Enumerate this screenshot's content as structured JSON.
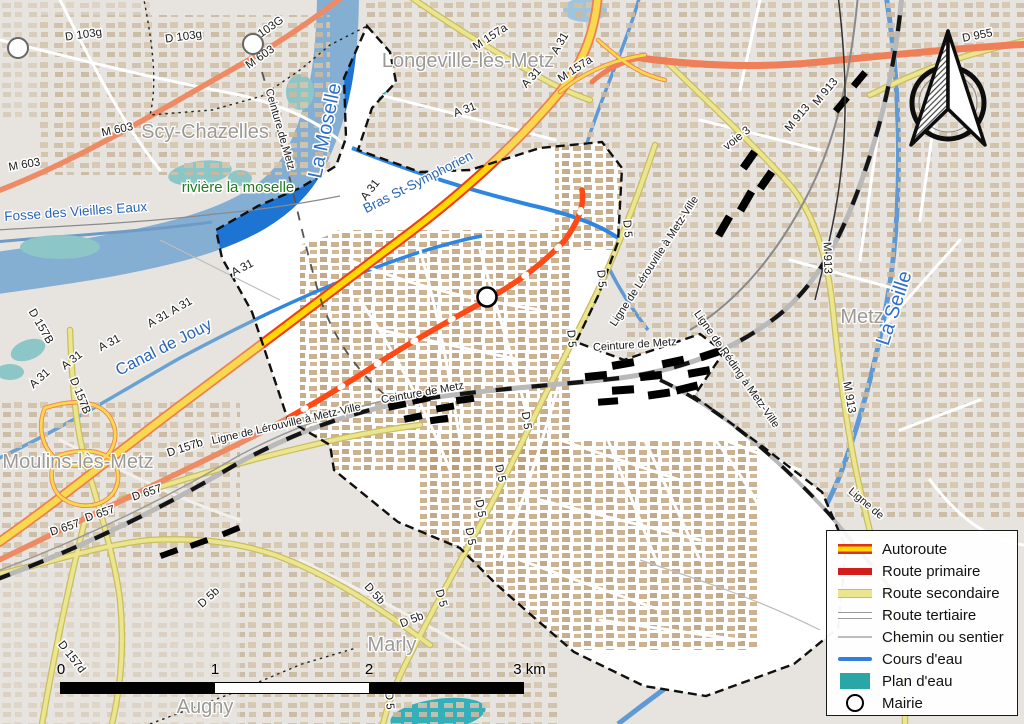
{
  "map": {
    "labels": [
      {
        "name": "d103g-1",
        "text": "D 103g",
        "x": 84,
        "y": 38,
        "r": -8,
        "kind": "road"
      },
      {
        "name": "d103g-2",
        "text": "D 103g",
        "x": 184,
        "y": 40,
        "r": -8,
        "kind": "road"
      },
      {
        "name": "d103g-3",
        "text": "D 103G",
        "x": 268,
        "y": 33,
        "r": -35,
        "kind": "road"
      },
      {
        "name": "m603-1",
        "text": "M 603",
        "x": 262,
        "y": 60,
        "r": -35,
        "kind": "road"
      },
      {
        "name": "m603-2",
        "text": "M 603",
        "x": 118,
        "y": 133,
        "r": -12,
        "kind": "road"
      },
      {
        "name": "m603-3",
        "text": "M 603",
        "x": 25,
        "y": 168,
        "r": -10,
        "kind": "road"
      },
      {
        "name": "m157a-1",
        "text": "M 157a",
        "x": 492,
        "y": 40,
        "r": -33,
        "kind": "road"
      },
      {
        "name": "a31-1",
        "text": "A 31",
        "x": 563,
        "y": 45,
        "r": -60,
        "kind": "road"
      },
      {
        "name": "m157a-2",
        "text": "M 157a",
        "x": 577,
        "y": 72,
        "r": -33,
        "kind": "road"
      },
      {
        "name": "a31-2",
        "text": "A 31",
        "x": 534,
        "y": 80,
        "r": -48,
        "kind": "road"
      },
      {
        "name": "a31-3",
        "text": "A 31",
        "x": 466,
        "y": 113,
        "r": -20,
        "kind": "road"
      },
      {
        "name": "a31-4",
        "text": "A 31",
        "x": 373,
        "y": 192,
        "r": -52,
        "kind": "road"
      },
      {
        "name": "a31-5",
        "text": "A 31",
        "x": 244,
        "y": 271,
        "r": -28,
        "kind": "road"
      },
      {
        "name": "a31-6",
        "text": "A 31",
        "x": 160,
        "y": 322,
        "r": -30,
        "kind": "road"
      },
      {
        "name": "a31-7",
        "text": "A 31",
        "x": 183,
        "y": 309,
        "r": -30,
        "kind": "road"
      },
      {
        "name": "a31-8",
        "text": "A 31",
        "x": 111,
        "y": 346,
        "r": -28,
        "kind": "road"
      },
      {
        "name": "a31-9",
        "text": "A 31",
        "x": 74,
        "y": 363,
        "r": -38,
        "kind": "road"
      },
      {
        "name": "a31-10",
        "text": "A 31",
        "x": 42,
        "y": 381,
        "r": -42,
        "kind": "road"
      },
      {
        "name": "d157B-1",
        "text": "D 157B",
        "x": 38,
        "y": 328,
        "r": 60,
        "kind": "road"
      },
      {
        "name": "d157B-2",
        "text": "D 157B",
        "x": 77,
        "y": 397,
        "r": 68,
        "kind": "road"
      },
      {
        "name": "d955",
        "text": "D 955",
        "x": 978,
        "y": 39,
        "r": -11,
        "kind": "road"
      },
      {
        "name": "m913-1",
        "text": "M 913",
        "x": 800,
        "y": 120,
        "r": -50,
        "kind": "road"
      },
      {
        "name": "m913-2",
        "text": "M 913",
        "x": 828,
        "y": 94,
        "r": -50,
        "kind": "road"
      },
      {
        "name": "m913-3",
        "text": "M 913",
        "x": 824,
        "y": 258,
        "r": 88,
        "kind": "road"
      },
      {
        "name": "m913-4",
        "text": "M 913",
        "x": 846,
        "y": 398,
        "r": 80,
        "kind": "road"
      },
      {
        "name": "voie3",
        "text": "voie 3",
        "x": 739,
        "y": 141,
        "r": -38,
        "kind": "road"
      },
      {
        "name": "d5-1",
        "text": "D 5",
        "x": 624,
        "y": 229,
        "r": 85,
        "kind": "road"
      },
      {
        "name": "d5-2",
        "text": "D 5",
        "x": 598,
        "y": 279,
        "r": 85,
        "kind": "road"
      },
      {
        "name": "d5-3",
        "text": "D 5",
        "x": 568,
        "y": 339,
        "r": 85,
        "kind": "road"
      },
      {
        "name": "d5-4",
        "text": "D 5",
        "x": 523,
        "y": 421,
        "r": 82,
        "kind": "road"
      },
      {
        "name": "d5-5",
        "text": "D 5",
        "x": 497,
        "y": 474,
        "r": 78,
        "kind": "road"
      },
      {
        "name": "d5-6",
        "text": "D 5",
        "x": 477,
        "y": 509,
        "r": 80,
        "kind": "road"
      },
      {
        "name": "d5-7",
        "text": "D 5",
        "x": 467,
        "y": 537,
        "r": 80,
        "kind": "road"
      },
      {
        "name": "d5-8",
        "text": "D 5",
        "x": 438,
        "y": 599,
        "r": 75,
        "kind": "road"
      },
      {
        "name": "d5-9",
        "text": "D 5",
        "x": 386,
        "y": 701,
        "r": 85,
        "kind": "road"
      },
      {
        "name": "d5b-1",
        "text": "D 5b",
        "x": 211,
        "y": 600,
        "r": -42,
        "kind": "road"
      },
      {
        "name": "d5b-2",
        "text": "D 5b",
        "x": 372,
        "y": 596,
        "r": 48,
        "kind": "road"
      },
      {
        "name": "d5b-3",
        "text": "D 5b",
        "x": 413,
        "y": 623,
        "r": -22,
        "kind": "road"
      },
      {
        "name": "d657-1",
        "text": "D 657",
        "x": 66,
        "y": 531,
        "r": -18,
        "kind": "road"
      },
      {
        "name": "d657-2",
        "text": "D 657",
        "x": 101,
        "y": 517,
        "r": -18,
        "kind": "road"
      },
      {
        "name": "d657-3",
        "text": "D 657",
        "x": 148,
        "y": 496,
        "r": -18,
        "kind": "road"
      },
      {
        "name": "d157b-3",
        "text": "D 157b",
        "x": 186,
        "y": 451,
        "r": -18,
        "kind": "road"
      },
      {
        "name": "d157d",
        "text": "D 157d",
        "x": 69,
        "y": 659,
        "r": 52,
        "kind": "road"
      },
      {
        "name": "ligne-lerouville-sw",
        "text": "Ligne de Lérouville à Metz-Ville",
        "x": 287,
        "y": 427,
        "r": -13,
        "kind": "rail"
      },
      {
        "name": "ceinture-sw",
        "text": "Ceinture de Metz",
        "x": 423,
        "y": 396,
        "r": -10,
        "kind": "rail"
      },
      {
        "name": "ligne-lerouville-ne",
        "text": "Ligne de Lérouville à Metz-Ville",
        "x": 657,
        "y": 263,
        "r": -57,
        "kind": "rail"
      },
      {
        "name": "ceinture-c",
        "text": "Ceinture de Metz",
        "x": 635,
        "y": 348,
        "r": -4,
        "kind": "rail"
      },
      {
        "name": "ceinture-n",
        "text": "Ceinture de Metz",
        "x": 277,
        "y": 130,
        "r": 74,
        "kind": "rail"
      },
      {
        "name": "ligne-reding",
        "text": "Ligne de Réding à Metz-Ville",
        "x": 734,
        "y": 371,
        "r": 55,
        "kind": "rail"
      },
      {
        "name": "ligne-partial",
        "text": "Ligne de",
        "x": 864,
        "y": 506,
        "r": 40,
        "kind": "rail"
      },
      {
        "name": "la-moselle",
        "text": "La Moselle",
        "x": 331,
        "y": 132,
        "r": -78,
        "kind": "water-lg"
      },
      {
        "name": "la-seille",
        "text": "La Seille",
        "x": 900,
        "y": 310,
        "r": -72,
        "kind": "water-lg"
      },
      {
        "name": "bras-st-symphorien",
        "text": "Bras St-Symphorien",
        "x": 420,
        "y": 186,
        "r": -27,
        "kind": "water"
      },
      {
        "name": "canal-de-jouy",
        "text": "Canal de Jouy",
        "x": 166,
        "y": 352,
        "r": -27,
        "kind": "water-md"
      },
      {
        "name": "fosse-des-vieilles-eaux",
        "text": "Fosse des Vieilles Eaux",
        "x": 76,
        "y": 216,
        "r": -4,
        "kind": "water"
      },
      {
        "name": "riviere-la-moselle",
        "text": "rivière la moselle",
        "x": 238,
        "y": 192,
        "r": 0,
        "kind": "green"
      },
      {
        "name": "longeville",
        "text": "Longeville-lès-Metz",
        "x": 468,
        "y": 67,
        "r": 0,
        "kind": "place"
      },
      {
        "name": "scy-chazelles",
        "text": "Scy-Chazelles",
        "x": 205,
        "y": 138,
        "r": 0,
        "kind": "place"
      },
      {
        "name": "moulins",
        "text": "Moulins-lès-Metz",
        "x": 78,
        "y": 468,
        "r": 0,
        "kind": "place"
      },
      {
        "name": "metz",
        "text": "Metz",
        "x": 862,
        "y": 323,
        "r": 0,
        "kind": "place"
      },
      {
        "name": "marly",
        "text": "Marly",
        "x": 392,
        "y": 651,
        "r": 0,
        "kind": "place"
      },
      {
        "name": "augny",
        "text": "Augny",
        "x": 205,
        "y": 713,
        "r": 0,
        "kind": "place"
      }
    ],
    "markers": [
      {
        "name": "mairie-marker",
        "x": 487,
        "y": 297,
        "kind": "mairie"
      },
      {
        "name": "circle-marker-nw",
        "x": 18,
        "y": 48,
        "kind": "secondary"
      },
      {
        "name": "circle-marker-scy",
        "x": 253,
        "y": 44,
        "kind": "secondary"
      }
    ]
  },
  "legend": {
    "items": [
      {
        "label": "Autoroute",
        "swatch": "autoroute"
      },
      {
        "label": "Route primaire",
        "swatch": "primaire"
      },
      {
        "label": "Route secondaire",
        "swatch": "secondaire"
      },
      {
        "label": "Route tertiaire",
        "swatch": "tertiaire"
      },
      {
        "label": "Chemin ou sentier",
        "swatch": "chemin"
      },
      {
        "label": "Cours d'eau",
        "swatch": "cours"
      },
      {
        "label": "Plan d'eau",
        "swatch": "plan"
      },
      {
        "label": "Mairie",
        "swatch": "mairie"
      }
    ]
  },
  "scalebar": {
    "ticks": [
      {
        "label": "0"
      },
      {
        "label": "1"
      },
      {
        "label": "2"
      },
      {
        "label": "3 km"
      }
    ]
  },
  "compass": {
    "name": "north-arrow"
  },
  "colors": {
    "background": "#e7e4e0",
    "commune_fill": "#ffffff",
    "water_muted": "#85aed3",
    "water_bright": "#1d74d2",
    "pond_teal": "#2aa6a6",
    "autoroute_core": "#ffd90a",
    "autoroute_casing": "#e03314",
    "route_primaire": "#d31d1d",
    "route_primaire_map": "#ff4a18",
    "route_secondaire": "#ece590",
    "rail": "#141414",
    "place_label": "#9b9995",
    "water_label": "#2a65b4",
    "stream_label_green": "#227a22"
  }
}
